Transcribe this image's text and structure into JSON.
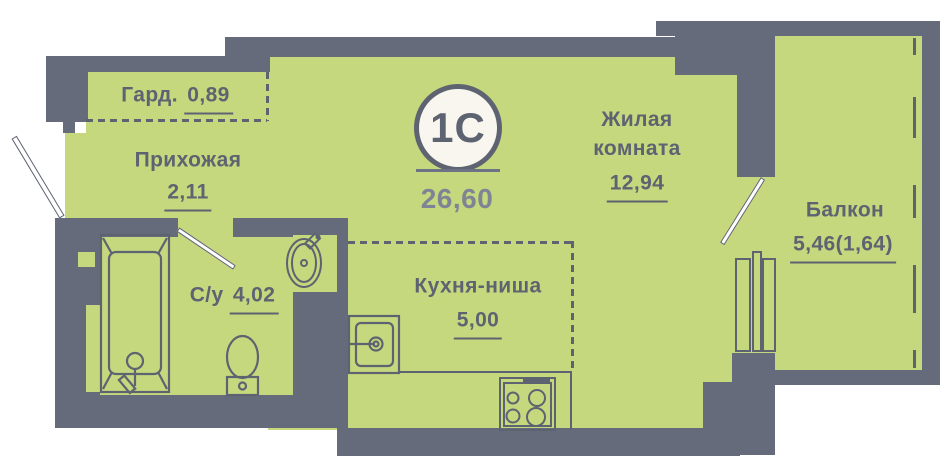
{
  "unit": {
    "type_badge": "1С",
    "total_area": "26,60"
  },
  "rooms": {
    "wardrobe": {
      "name": "Гард.",
      "area": "0,89"
    },
    "hallway": {
      "name": "Прихожая",
      "area": "2,11"
    },
    "bathroom": {
      "name": "С/у",
      "area": "4,02"
    },
    "kitchen": {
      "name": "Кухня-ниша",
      "area": "5,00"
    },
    "living": {
      "name_line1": "Жилая",
      "name_line2": "комната",
      "area": "12,94"
    },
    "balcony": {
      "name": "Балкон",
      "area": "5,46(1,64)"
    }
  },
  "colors": {
    "floor": "#c6d87e",
    "wall": "#666b7b",
    "line": "#5d6370",
    "badge_bg": "#f8f6ee",
    "area_text": "#7e8494"
  }
}
